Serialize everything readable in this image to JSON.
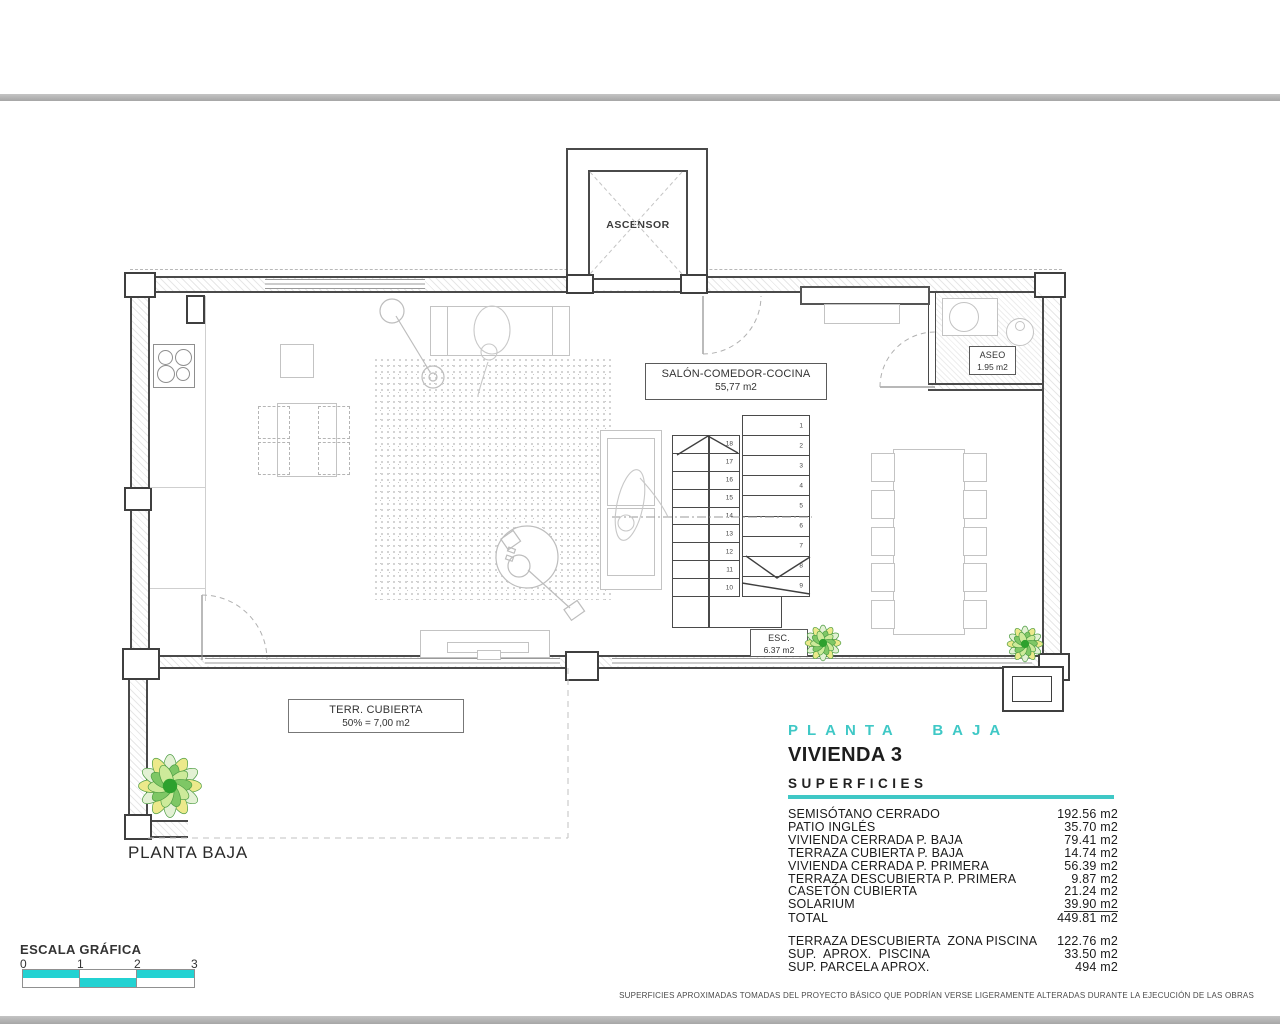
{
  "colors": {
    "accent_cyan": "#3fc8c6",
    "scale_cyan": "#23d2d2",
    "bar_gray": "#a6a6a6"
  },
  "plan": {
    "ascensor": "ASCENSOR",
    "salon_line1": "SALÓN-COMEDOR-COCINA",
    "salon_line2": "55,77 m2",
    "aseo_line1": "ASEO",
    "aseo_line2": "1.95 m2",
    "esc_line1": "ESC.",
    "esc_line2": "6.37 m2",
    "terraza_line1": "TERR. CUBIERTA",
    "terraza_line2": "50% = 7,00 m2",
    "floor_label": "PLANTA BAJA",
    "stair_numbers_right": [
      "1",
      "2",
      "3",
      "4",
      "5",
      "6",
      "7",
      "8",
      "9"
    ],
    "stair_numbers_left": [
      "18",
      "17",
      "16",
      "15",
      "14",
      "13",
      "12",
      "11",
      "10"
    ]
  },
  "info_panel": {
    "floor_title": "PLANTA BAJA",
    "unit_title": "VIVIENDA 3",
    "section_title": "SUPERFICIES",
    "surfaces": [
      {
        "label": "SEMISÓTANO CERRADO",
        "value": "192.56 m2"
      },
      {
        "label": "PATIO INGLÉS",
        "value": "35.70 m2"
      },
      {
        "label": "VIVIENDA CERRADA P. BAJA",
        "value": "79.41 m2"
      },
      {
        "label": "TERRAZA CUBIERTA P. BAJA",
        "value": "14.74 m2"
      },
      {
        "label": "VIVIENDA CERRADA P. PRIMERA",
        "value": "56.39 m2"
      },
      {
        "label": "TERRAZA DESCUBIERTA P. PRIMERA",
        "value": "9.87 m2"
      },
      {
        "label": "CASETÓN CUBIERTA",
        "value": "21.24 m2"
      },
      {
        "label": "SOLARIUM",
        "value": "39.90 m2",
        "underline": true
      },
      {
        "label": "TOTAL",
        "value": "449.81 m2"
      }
    ],
    "surfaces_extra": [
      {
        "label": "TERRAZA DESCUBIERTA  ZONA PISCINA",
        "value": "122.76 m2"
      },
      {
        "label": "SUP.  APROX.  PISCINA",
        "value": "33.50 m2"
      },
      {
        "label": "SUP. PARCELA APROX.",
        "value": "494 m2"
      }
    ]
  },
  "scale_bar": {
    "title": "ESCALA GRÁFICA",
    "ticks": [
      "0",
      "1",
      "2",
      "3"
    ]
  },
  "disclaimer": "SUPERFICIES APROXIMADAS TOMADAS DEL PROYECTO BÁSICO QUE PODRÍAN VERSE LIGERAMENTE ALTERADAS DURANTE LA EJECUCIÓN DE LAS OBRAS"
}
